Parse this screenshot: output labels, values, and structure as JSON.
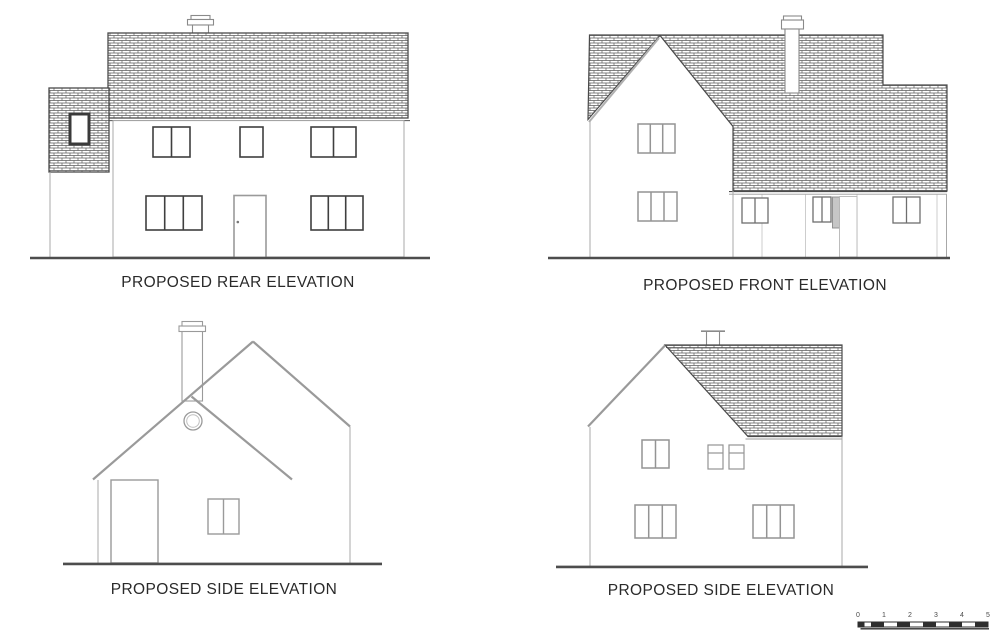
{
  "captions": {
    "rear": "PROPOSED REAR ELEVATION",
    "front": "PROPOSED FRONT ELEVATION",
    "side_left": "PROPOSED SIDE ELEVATION",
    "side_right": "PROPOSED SIDE ELEVATION"
  },
  "scale_bar": {
    "labels": [
      "0",
      "1",
      "2",
      "3",
      "4",
      "5"
    ]
  },
  "colors": {
    "background": "#ffffff",
    "line_dark": "#4a4a4a",
    "line_gray": "#9a9a9a",
    "text": "#2a2a2a"
  }
}
